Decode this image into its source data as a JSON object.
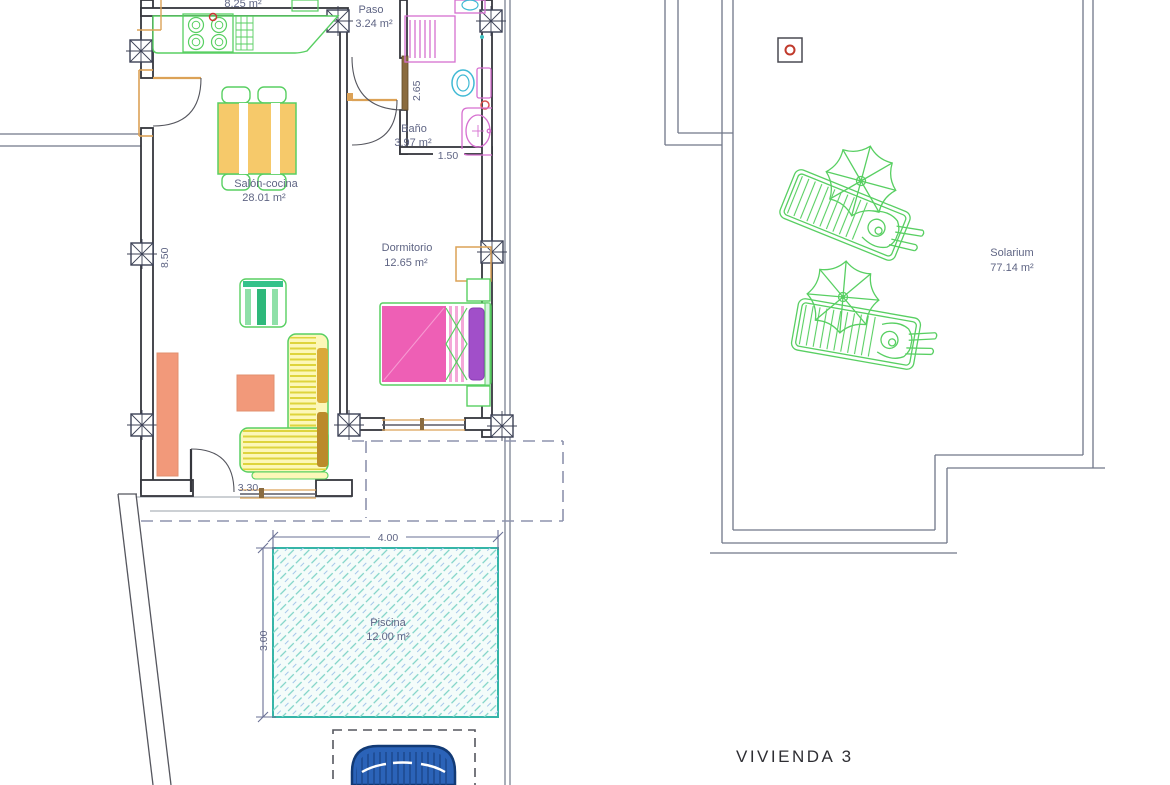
{
  "title": {
    "label": "VIVIENDA 3"
  },
  "rooms": {
    "kitchen": {
      "area": "8.25 m²"
    },
    "paso": {
      "name": "Paso",
      "area": "3.24 m²"
    },
    "salon": {
      "name": "Salón-cocina",
      "area": "28.01 m²"
    },
    "bano": {
      "name": "Baño",
      "area": "3.97 m²"
    },
    "dormitorio": {
      "name": "Dormitorio",
      "area": "12.65 m²"
    },
    "piscina": {
      "name": "Piscina",
      "area": "12.00 m²"
    },
    "solarium": {
      "name": "Solarium",
      "area": "77.14 m²"
    }
  },
  "dimensions": {
    "salon_height": "8.50",
    "bano_height": "2.65",
    "bano_width": "1.50",
    "salon_door_width": "3.30",
    "pool_width": "4.00",
    "pool_depth": "3.00"
  },
  "colors": {
    "wall": "#35363c",
    "label_text": "#5f6584",
    "furniture_green": "#58cf62",
    "frame_orange": "#dca257",
    "salmon": "#f2997a",
    "table_yellow": "#f6c96a",
    "sofa_yellow": "#efe84e",
    "bed_pink": "#ee5fb5",
    "pillow_purple": "#a14fc9",
    "bath_pink": "#d66fd0",
    "toilet_cyan": "#3fb9d4",
    "pool_teal": "#35b5a8",
    "car_blue": "#2b63b8",
    "dashed_boundary": "#8d93ad"
  }
}
